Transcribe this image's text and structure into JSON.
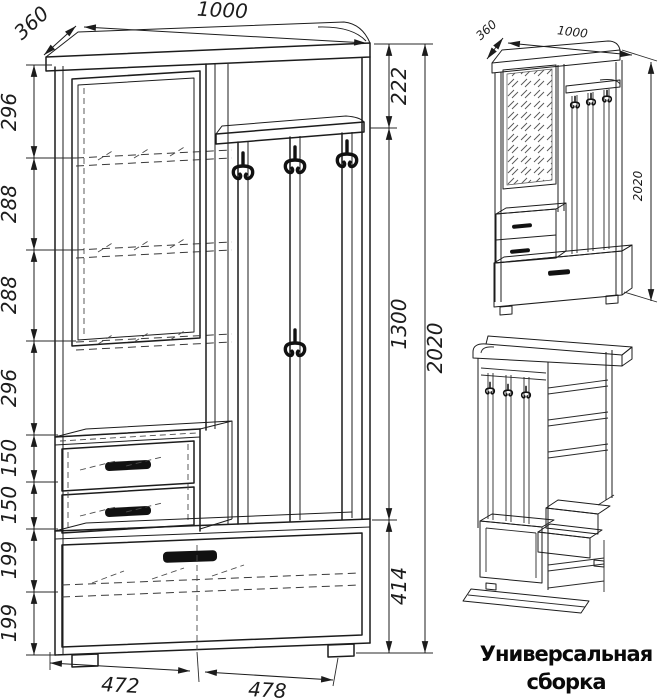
{
  "colors": {
    "ink": "#1c1c1c",
    "hatch": "#6b6b6b",
    "background": "#ffffff",
    "hook": "#111111"
  },
  "front_view": {
    "dim_width_top": "1000",
    "dim_depth": "360",
    "left_chain": [
      "296",
      "288",
      "288",
      "296",
      "150",
      "150",
      "199",
      "199"
    ],
    "dim_top_right": "222",
    "dim_middle_right": "1300",
    "dim_bottom_right": "414",
    "dim_overall_height": "2020",
    "dim_bottom_left_width": "472",
    "dim_bottom_right_width": "478"
  },
  "iso_view": {
    "dim_depth": "360",
    "dim_width": "1000",
    "dim_height": "2020"
  },
  "caption": {
    "line1": "Универсальная",
    "line2": "сборка"
  }
}
